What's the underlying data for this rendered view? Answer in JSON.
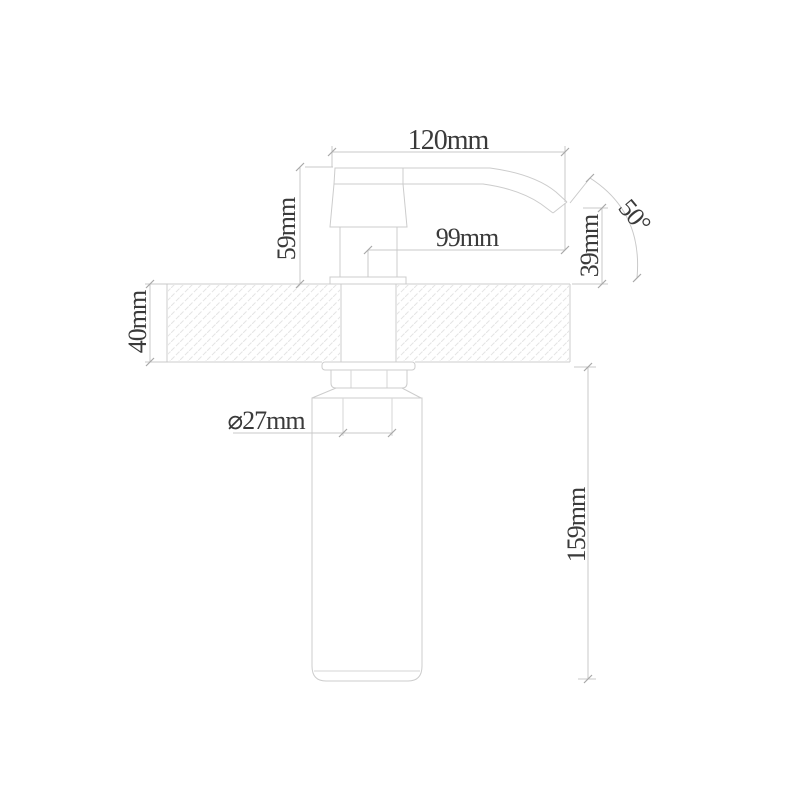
{
  "drawing": {
    "background": "#ffffff",
    "colors": {
      "object_line": "#cccccc",
      "dimension_line": "#c9c9c9",
      "hatch_line": "#e4e4e4",
      "tick": "#a8a8a8",
      "text": "#3a3a3a"
    },
    "dimensions": {
      "overall_width": {
        "label": "120mm",
        "value": 120,
        "unit": "mm"
      },
      "head_height": {
        "label": "59mm",
        "value": 59,
        "unit": "mm"
      },
      "spout_reach": {
        "label": "99mm",
        "value": 99,
        "unit": "mm"
      },
      "spout_drop": {
        "label": "39mm",
        "value": 39,
        "unit": "mm"
      },
      "spout_angle": {
        "label": "50°",
        "value": 50,
        "unit": "deg"
      },
      "deck_thickness": {
        "label": "40mm",
        "value": 40,
        "unit": "mm"
      },
      "tube_diameter": {
        "label": "⌀27mm",
        "value": 27,
        "unit": "mm"
      },
      "bottle_height": {
        "label": "159mm",
        "value": 159,
        "unit": "mm"
      }
    }
  }
}
